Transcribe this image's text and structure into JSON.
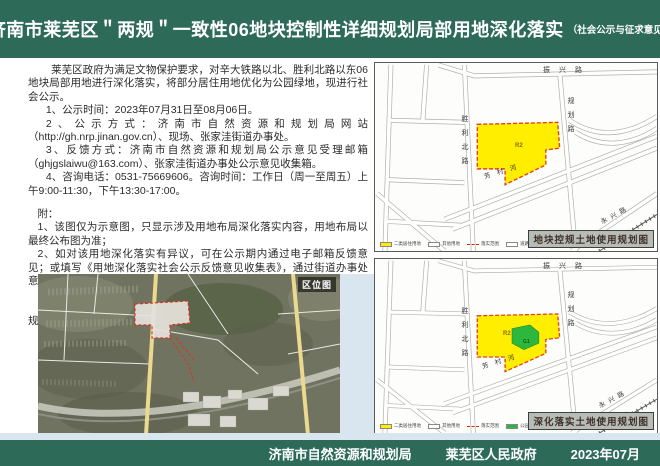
{
  "header": {
    "title": "济南市莱芜区＂两规＂一致性06地块控制性详细规划局部用地深化落实",
    "subtitle": "（社会公示与征求意见）"
  },
  "notice": {
    "intro": "莱芜区政府为满足文物保护要求，对辛大铁路以北、胜利北路以东06地块局部用地进行深化落实，将部分居住用地优化为公园绿地，现进行社会公示。",
    "items": [
      "1、公示时间：2023年07月31日至08月06日。",
      "2、公示方式：济南市自然资源和规划局网站（http://gh.nrp.jinan.gov.cn）、现场、张家洼街道办事处。",
      "3、反馈方式：济南市自然资源和规划局公示意见受理邮箱（ghjgslaiwu@163.com）、张家洼街道办事处公示意见收集箱。",
      "4、咨询电话：0531-75669606。咨询时间：工作日（周一至周五）上午9:00-11:30，下午13:30-17:00。"
    ],
    "appendix_label": "附：",
    "appendix": [
      "1、该图仅为示意图，只显示涉及用地布局深化落实内容，用地布局以最终公布图为准；",
      "2、如对该用地深化落实有异议，可在公示期内通过电子邮箱反馈意见；或填写《用地深化落实社会公示反馈意见收集表》，通过街道办事处意见收集箱反馈。有效反馈意见需注明联系人、联系电话、联系地址。",
      "3、如涉及深化落实的动因及建设实施等事宜，请拨打咨询电话。",
      "4、公示意见收集、采纳情况及深化最终方案将通过济南市自然资源和规划局官网进行公告。"
    ]
  },
  "roads": {
    "top": "振兴路",
    "west": "胜利北路",
    "east": "规划路",
    "river": "芳村河",
    "southeast": "永兴路",
    "railway": "辛大铁路"
  },
  "location_map": {
    "label": "区位图"
  },
  "maps": [
    {
      "caption": "地块控规土地使用规划图",
      "plot_label": "R2",
      "legend": [
        {
          "label": "二类居住用地"
        },
        {
          "label": "其他用地"
        },
        {
          "label": "落实范围"
        },
        {
          "label": "道路"
        }
      ]
    },
    {
      "caption": "深化落实土地使用规划图",
      "plot_label": "R2",
      "park_label": "G1",
      "legend": [
        {
          "label": "二类居住用地"
        },
        {
          "label": "其他用地"
        },
        {
          "label": "落实范围"
        },
        {
          "label": "公园绿地"
        },
        {
          "label": "道路"
        }
      ]
    }
  ],
  "footer": {
    "agency": "济南市自然资源和规划局",
    "government": "莱芜区人民政府",
    "date": "2023年07月"
  },
  "colors": {
    "theme_green": "#2d6b58",
    "plot_yellow": "#ffee00",
    "park_green": "#2db83d",
    "boundary_red": "#e8401c",
    "accent_blue": "#d9e5ef"
  }
}
